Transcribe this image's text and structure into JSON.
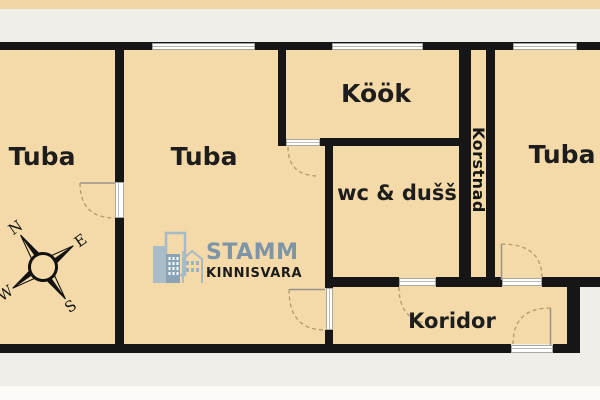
{
  "rooms": [
    {
      "id": "tuba-left",
      "label": "Tuba"
    },
    {
      "id": "tuba-middle",
      "label": "Tuba"
    },
    {
      "id": "kook",
      "label": "Köök"
    },
    {
      "id": "wc-duss",
      "label": "wc & dušš"
    },
    {
      "id": "tuba-right",
      "label": "Tuba"
    },
    {
      "id": "koridor",
      "label": "Koridor"
    },
    {
      "id": "korstnad-shaft",
      "label": "Korstnad"
    }
  ],
  "compass": {
    "north": "N",
    "east": "E",
    "south": "S",
    "west": "W"
  },
  "logo": {
    "name": "STAMM",
    "tagline": "KINNISVARA"
  },
  "colors": {
    "room_fill": "#f4d9a9",
    "wall": "#161616",
    "background_grey": "#efeee9",
    "logo_accent": "#7d95a6",
    "door_arc": "#b39a6b"
  }
}
